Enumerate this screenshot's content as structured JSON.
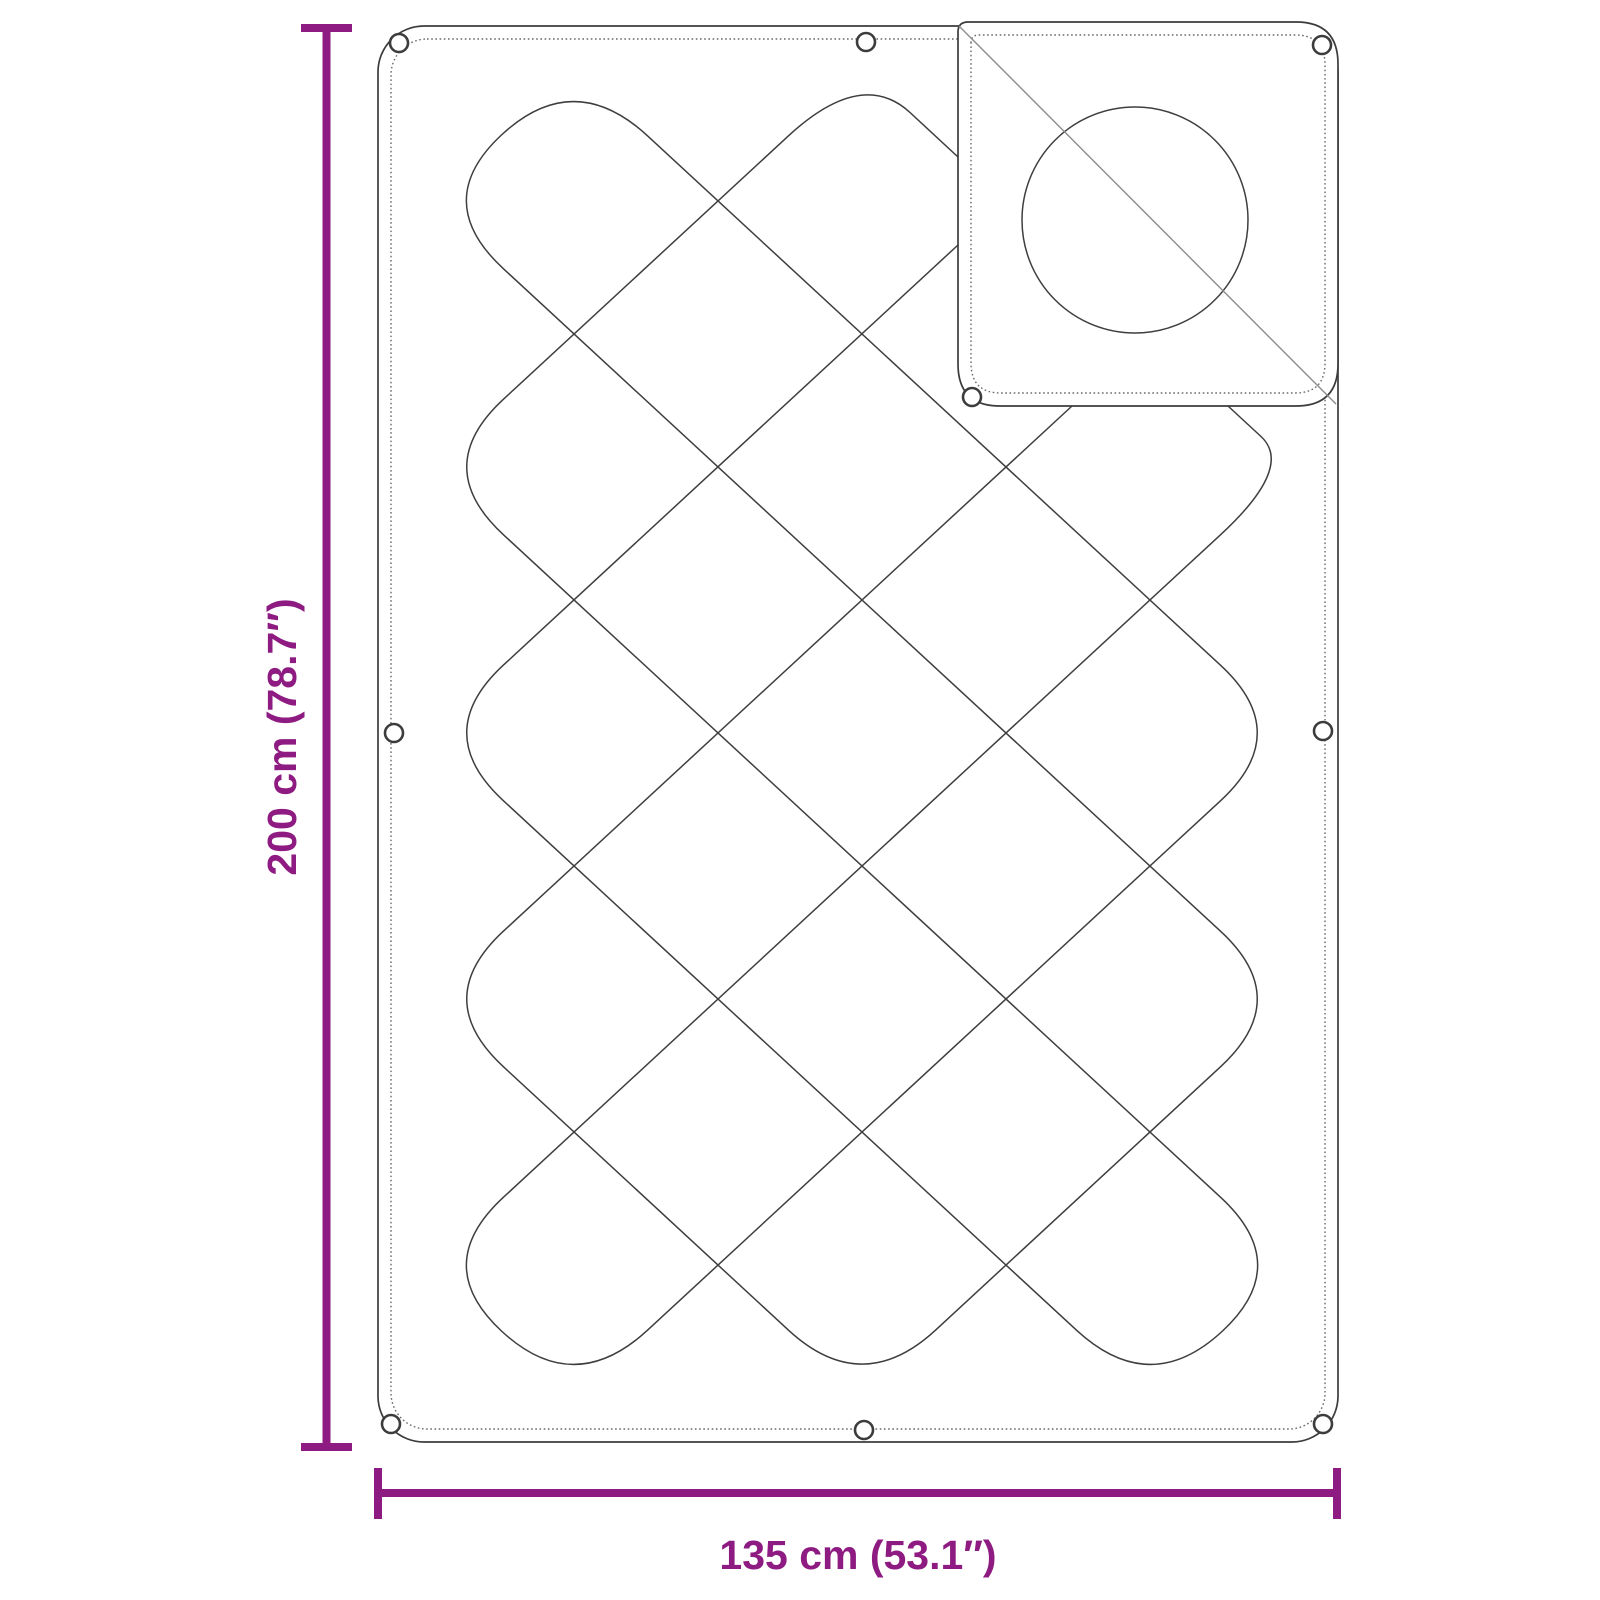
{
  "diagram": {
    "type": "product-dimension-diagram",
    "subject": "quilted duvet with pillow, corner folded",
    "background_color": "#ffffff",
    "accent_color": "#8E1B81",
    "outline_color": "#3c3c3c",
    "stitch_color": "#6a6a6a",
    "fold_line_color": "#8c8c8c",
    "height": {
      "cm": 200,
      "inches": 78.7,
      "label": "200 cm (78.7″)"
    },
    "width": {
      "cm": 135,
      "inches": 53.1,
      "label": "135 cm (53.1″)"
    },
    "grommet_count": 9
  }
}
